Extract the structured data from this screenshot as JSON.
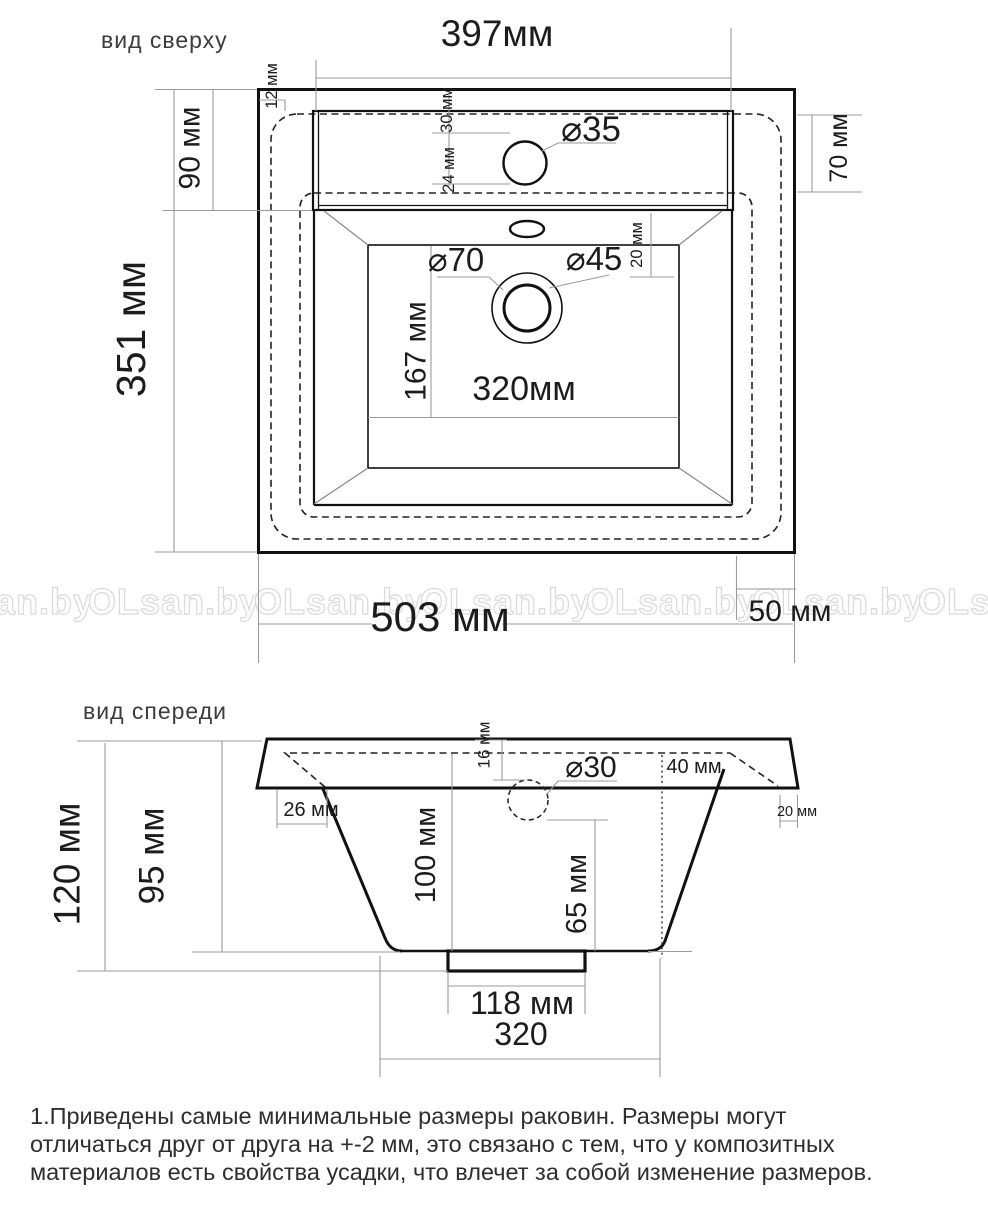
{
  "top_view": {
    "title": "вид сверху",
    "dim_width_top": "397мм",
    "dim_offset_left": "12 мм",
    "dim_deck_depth": "90 мм",
    "dim_hole_top": "30 мм",
    "dim_hole_bottom": "24 мм",
    "dim_tap_hole_diameter": "⌀35",
    "dim_right_edge": "70 мм",
    "dim_overall_depth": "351 мм",
    "dim_drain_outer": "⌀70",
    "dim_drain_inner": "⌀45",
    "dim_basin_offset": "20 мм",
    "dim_basin_depth": "167 мм",
    "dim_basin_width": "320мм",
    "dim_overall_width": "503 мм",
    "dim_overhang_right": "50 мм"
  },
  "front_view": {
    "title": "вид спереди",
    "dim_overall_height": "120 мм",
    "dim_body_height": "95 мм",
    "dim_rim_thickness": "16 мм",
    "dim_left_inset": "26 мм",
    "dim_overflow_diameter": "⌀30",
    "dim_right_inset": "40 мм",
    "dim_right_overhang": "20 мм",
    "dim_basin_depth": "100 мм",
    "dim_overflow_height": "65 мм",
    "dim_outlet_width": "118 мм",
    "dim_bottom_width": "320"
  },
  "watermark": {
    "text": "OLsan.by"
  },
  "note": {
    "line1": "1.Приведены самые минимальные размеры раковин. Размеры могут",
    "line2": "отличаться друг от друга на +-2 мм, это связано с тем, что у композитных",
    "line3": "материалов есть свойства усадки, что влечет за собой изменение размеров."
  }
}
